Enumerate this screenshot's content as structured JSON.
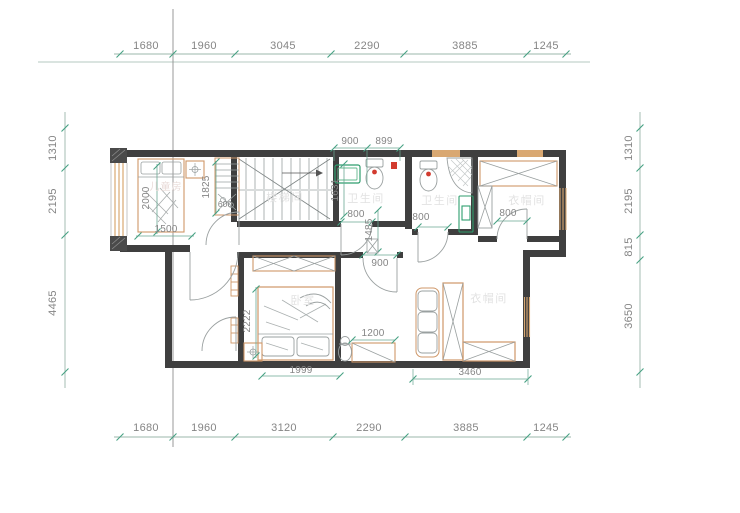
{
  "drawing_title": "floor-plan",
  "colors": {
    "wall": "#3f3f3f",
    "dim_line": "#9bb7ab",
    "dim_tick": "#46a183",
    "dim_text": "#858585",
    "wood_accent": "#cf9768",
    "window_tan": "#d9a872",
    "furniture_line": "#9aa0a0",
    "fixture_green": "#2f9e6e",
    "fixture_red": "#d23b2f",
    "watermark": "#e2e2e2"
  },
  "dims": {
    "top": [
      "1680",
      "1960",
      "3045",
      "2290",
      "3885",
      "1245"
    ],
    "bottom": [
      "1680",
      "1960",
      "3120",
      "2290",
      "3885",
      "1245"
    ],
    "left": [
      "1310",
      "2195",
      "4465"
    ],
    "right": [
      "1310",
      "2195",
      "815",
      "3650"
    ],
    "inner": {
      "bath_top_a": "900",
      "bath_top_b": "899",
      "bath1_niche": "1631",
      "child_bed_len": "2000",
      "child_bed_wid": "1500",
      "child_cabinet": "1825",
      "child_cabinet_depth": "600",
      "door_bath1": "800",
      "door_bath2": "800",
      "door_cloak1": "800",
      "corridor_v": "1485",
      "door_bedroom": "900",
      "bed_len": "2222",
      "bed_wid": "1999",
      "low_cabinet": "1200",
      "wardrobe_run": "3460"
    }
  },
  "rooms": {
    "child": "儿童房",
    "stair": "楼梯间",
    "bath1": "卫生间",
    "bath2": "卫生间",
    "cloak1": "衣帽间",
    "bedroom": "卧室",
    "cloak2": "衣帽间"
  }
}
